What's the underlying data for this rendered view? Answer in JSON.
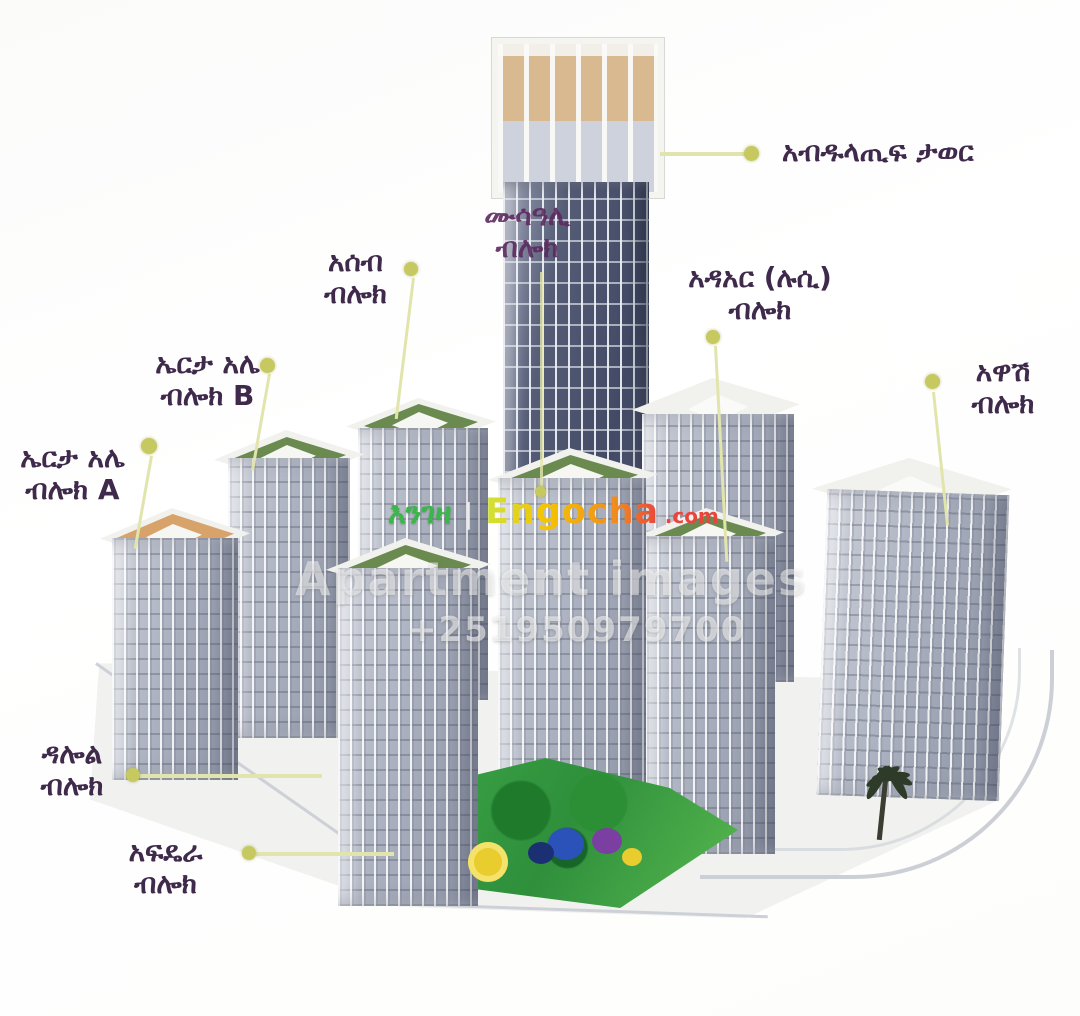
{
  "site_plan": {
    "tower_label": {
      "text": "አብዱላጢፍ ታወር"
    },
    "blocks": {
      "musa_ali": {
        "line1": "ሙሳዓሊ",
        "line2": "ብሎክ"
      },
      "aseb": {
        "line1": "አሰብ",
        "line2": "ብሎክ"
      },
      "erta_ale_b": {
        "line1": "ኤርታ አሌ",
        "line2": "ብሎክ B"
      },
      "erta_ale_a": {
        "line1": "ኤርታ አሌ",
        "line2": "ብሎክ A"
      },
      "adaar_lucy": {
        "line1": "አዳአር (ሉሲ)",
        "line2": "ብሎክ"
      },
      "awash": {
        "line1": "አዋሽ",
        "line2": "ብሎክ"
      },
      "dallol": {
        "line1": "ዳሎል",
        "line2": "ብሎክ"
      },
      "afdera": {
        "line1": "አፍዴራ",
        "line2": "ብሎክ"
      }
    }
  },
  "watermarks": {
    "brand_amharic": "እንገዛ",
    "separator": "|",
    "brand_latin": "Engocha",
    "brand_tld": ".com",
    "overlay_text": "Apartment images",
    "phone": "+251950979700"
  },
  "colors": {
    "label_text": "#3f2a4c",
    "musa_label_text": "#5d2a60",
    "leader_line": "#e2e5ab",
    "leader_dot": "#c6c95f",
    "brand_green": "#3cb54a",
    "brand_yellow": "#f5c400",
    "brand_red": "#e8453c",
    "tower_glass": "#424a65",
    "crown_tan": "#d9b98f",
    "roof_garden_green": "#6a8a50",
    "erta_a_deck_tan": "#d8a26b",
    "courtyard_green": "#2f8f3c"
  }
}
